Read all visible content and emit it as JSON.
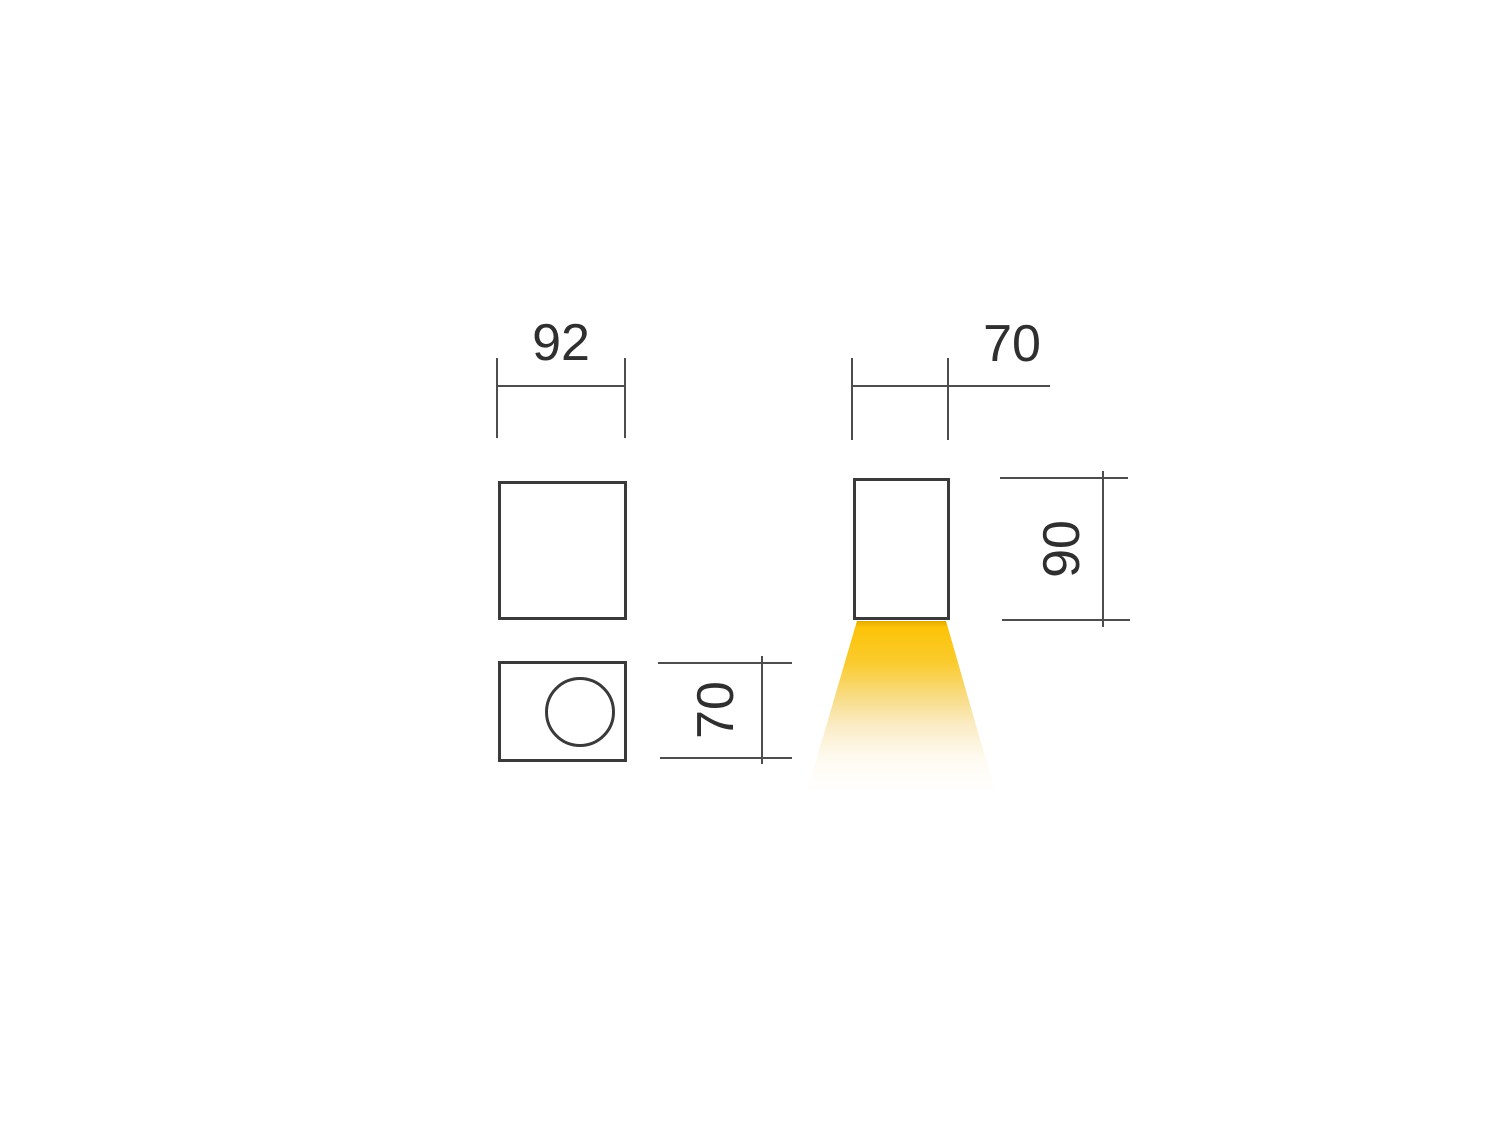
{
  "drawing": {
    "type": "luminaire-dimension-drawing",
    "dimensions": {
      "front_width": "92",
      "side_width": "70",
      "side_height": "90",
      "bottom_depth": "70"
    },
    "colors": {
      "line": "#3a3a3a",
      "dim_line": "#4d4d4d",
      "text": "#2f2f2f",
      "beam_edge": "#dfa900",
      "beam_top": "#fdc307",
      "beam_mid": "#f8dc86",
      "background": "#ffffff"
    }
  }
}
